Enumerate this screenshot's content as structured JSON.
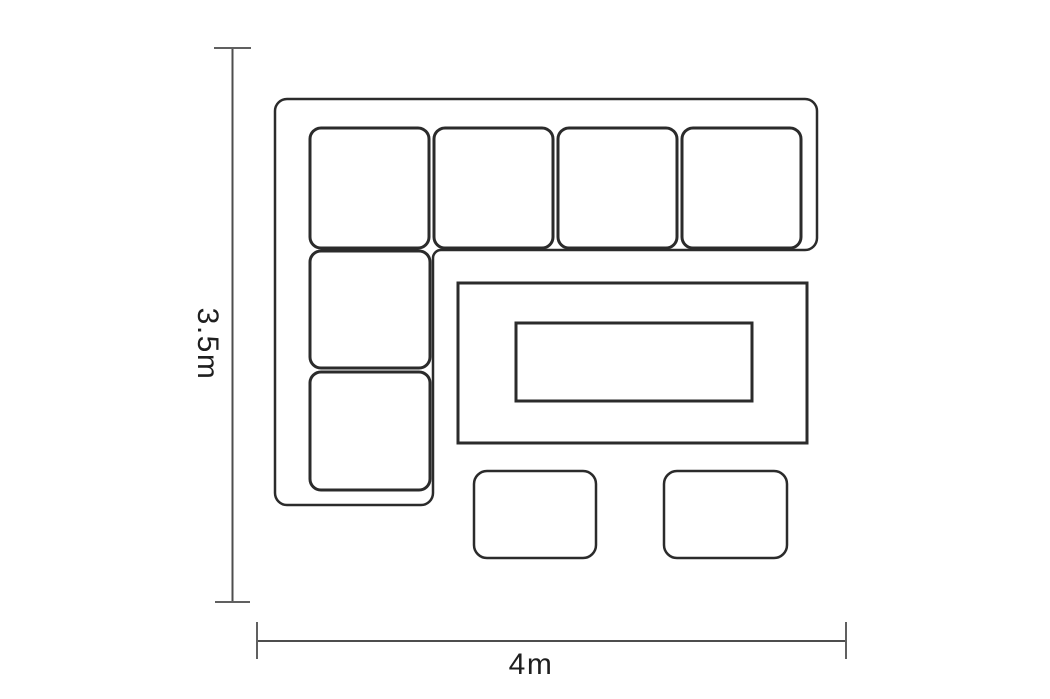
{
  "diagram": {
    "type": "furniture-floorplan",
    "dimensions": {
      "height_label": "3.5m",
      "width_label": "4m"
    },
    "furniture": {
      "corner_sofa_cushions_top_row": 4,
      "corner_sofa_cushions_left_column": 2,
      "coffee_table_count": 1,
      "stool_count": 2
    },
    "colors": {
      "furniture_line": "#2b2b2b",
      "dimension_line": "#4d4d4d",
      "dimension_tick": "#606060",
      "label_text": "#1f1f1f",
      "background": "#ffffff"
    }
  }
}
